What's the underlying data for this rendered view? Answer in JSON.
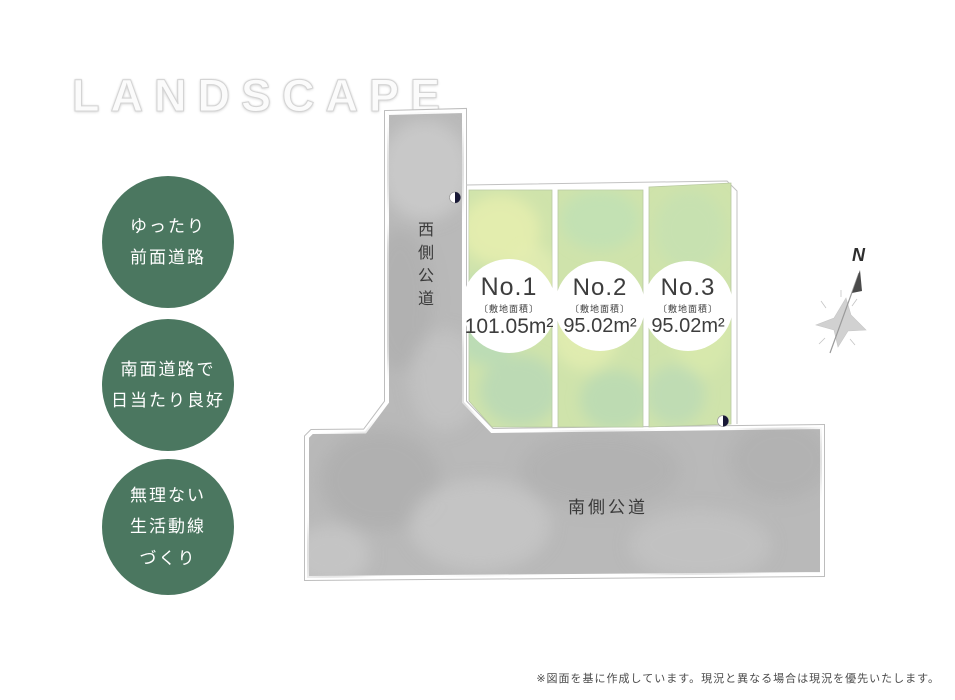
{
  "page": {
    "title": "LANDSCAPE"
  },
  "features": [
    {
      "lines": [
        "ゆったり",
        "前面道路"
      ]
    },
    {
      "lines": [
        "南面道路で",
        "日当たり良好"
      ]
    },
    {
      "lines": [
        "無理ない",
        "生活動線",
        "づくり"
      ]
    }
  ],
  "site_plan": {
    "west_road_label": "西側公道",
    "south_road_label": "南側公道",
    "compass_label": "N",
    "lots": [
      {
        "name": "No.1",
        "area_label": "〔敷地面積〕",
        "area_value": "101.05m²"
      },
      {
        "name": "No.2",
        "area_label": "〔敷地面積〕",
        "area_value": "95.02m²"
      },
      {
        "name": "No.3",
        "area_label": "〔敷地面積〕",
        "area_value": "95.02m²"
      }
    ],
    "colors": {
      "feature_circle_green": "#4b7760",
      "road_gray": "#b9b9b9",
      "lot_green_base": "#cfe3ab",
      "marker_navy": "#181836",
      "boundary_gray": "#bcbcbc"
    }
  },
  "footer": {
    "note": "※図面を基に作成しています。現況と異なる場合は現況を優先いたします。"
  }
}
